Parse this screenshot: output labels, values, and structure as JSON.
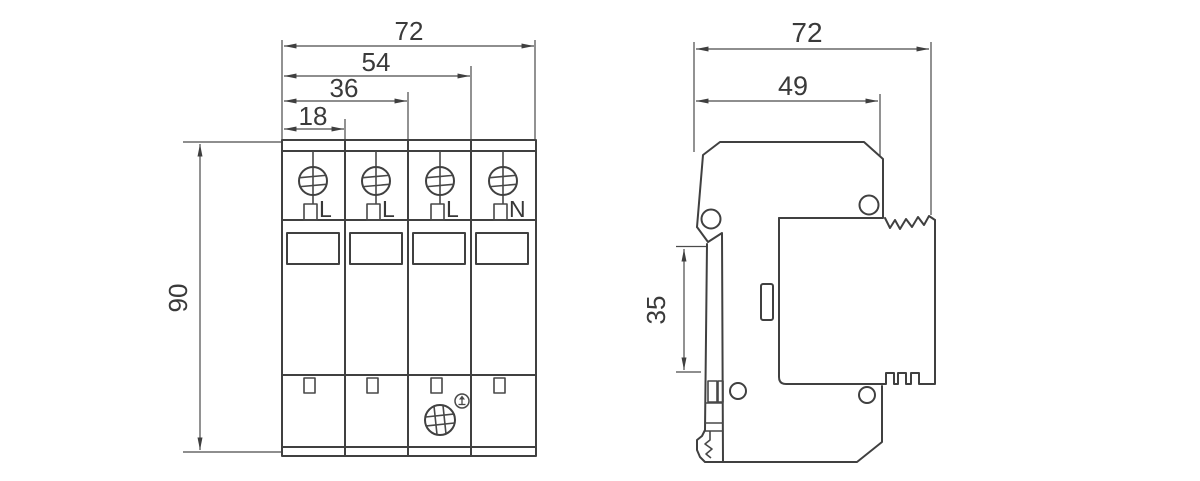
{
  "front_view": {
    "dim_total_width": "72",
    "dim_three_modules": "54",
    "dim_two_modules": "36",
    "dim_one_module": "18",
    "dim_height": "90",
    "terminals": [
      "L",
      "L",
      "L",
      "N"
    ]
  },
  "side_view": {
    "dim_total_width": "72",
    "dim_body_depth": "49",
    "dim_rail_height": "35"
  },
  "colors": {
    "line": "#404040",
    "background": "#ffffff"
  }
}
